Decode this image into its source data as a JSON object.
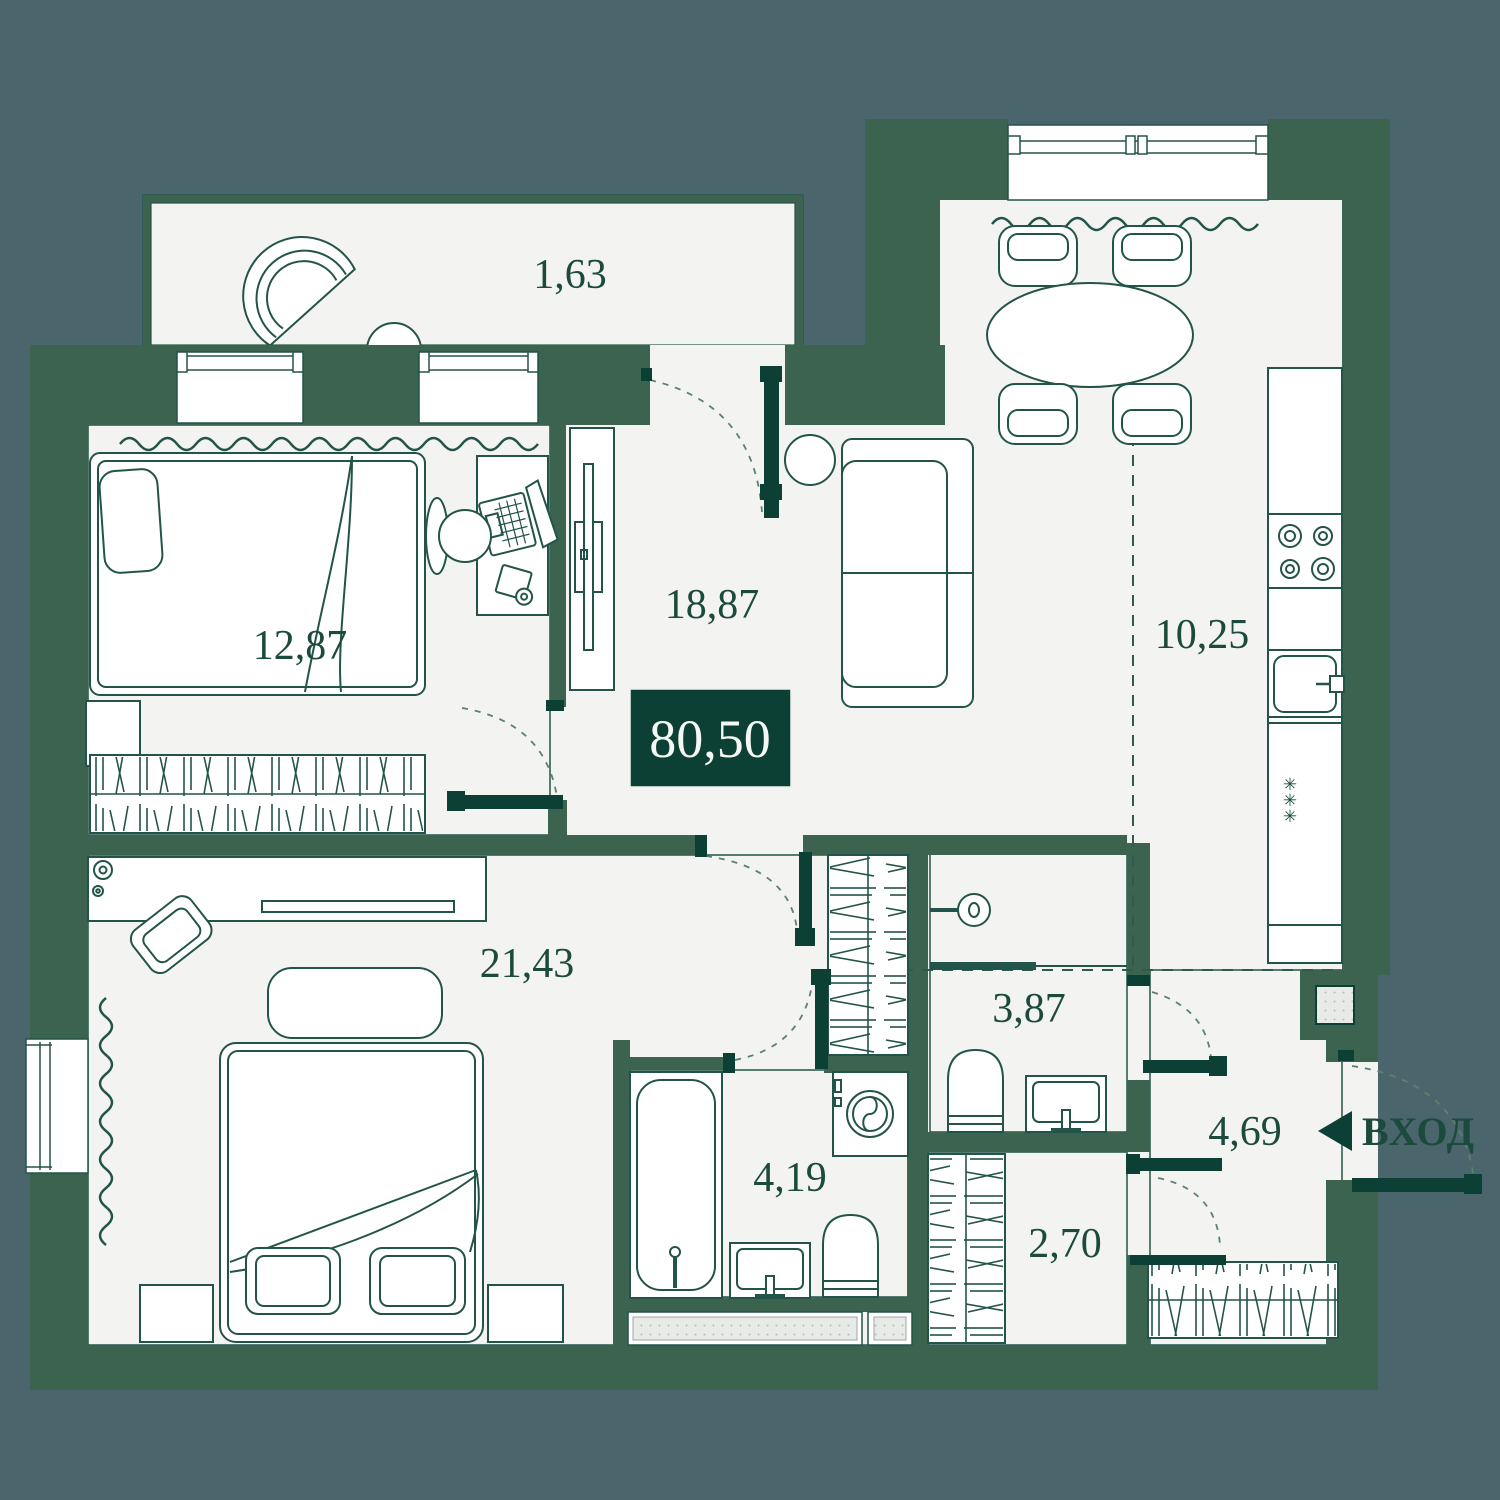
{
  "plan": {
    "total_area": "80,50",
    "entrance_label": "ВХОД",
    "rooms": [
      {
        "id": "balcony",
        "area": "1,63"
      },
      {
        "id": "bedroom-1",
        "area": "12,87"
      },
      {
        "id": "living-room",
        "area": "18,87"
      },
      {
        "id": "kitchen",
        "area": "10,25"
      },
      {
        "id": "bedroom-2",
        "area": "21,43"
      },
      {
        "id": "bathroom-ensuite",
        "area": "4,19"
      },
      {
        "id": "shower-room",
        "area": "3,87"
      },
      {
        "id": "closet",
        "area": "2,70"
      },
      {
        "id": "hallway",
        "area": "4,69"
      }
    ],
    "colors": {
      "background": "#4b656d",
      "wall": "#3c6350",
      "wall_dark": "#0c4034",
      "floor": "#f3f4f1",
      "line": "#235449",
      "label_text": "#1c4b3d",
      "badge_bg": "#0c4034",
      "badge_text": "#f5f7f4"
    }
  }
}
